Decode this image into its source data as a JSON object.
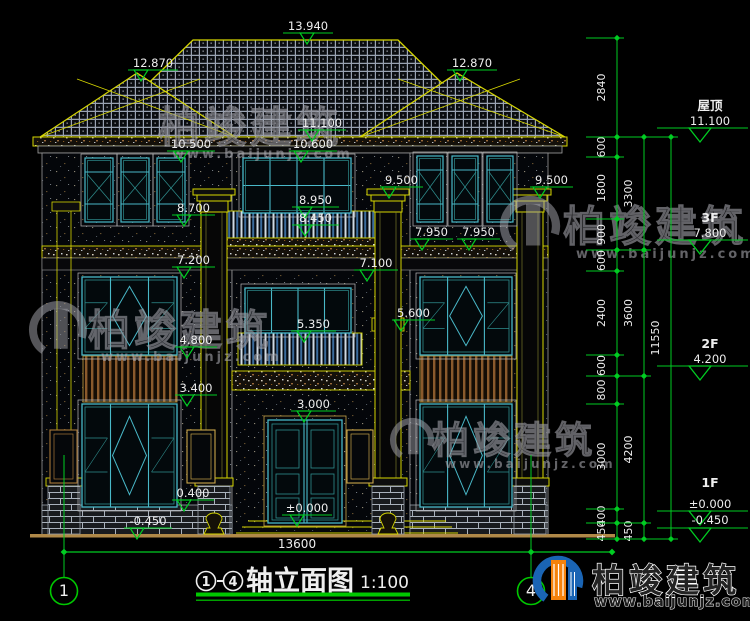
{
  "drawing_title": {
    "axis_from": "1",
    "axis_to": "4",
    "separator": "-",
    "text": "轴立面图",
    "scale": "1:100"
  },
  "axis_bubbles": [
    {
      "n": "1",
      "cx": 64
    },
    {
      "n": "4",
      "cx": 531
    }
  ],
  "bottom_dimension": {
    "value": "13600",
    "x1": 64,
    "x2": 531,
    "ext_x": 612,
    "y": 552,
    "text_x": 297,
    "text_y": 548
  },
  "elevation_markers": [
    {
      "v": "13.940",
      "x": 283,
      "w": 50,
      "y": 33,
      "tx": 307
    },
    {
      "v": "12.870",
      "x": 128,
      "w": 50,
      "y": 70,
      "tx": 141
    },
    {
      "v": "12.870",
      "x": 447,
      "w": 50,
      "y": 70,
      "tx": 460
    },
    {
      "v": "11.100",
      "x": 298,
      "w": 48,
      "y": 130,
      "tx": 312
    },
    {
      "v": "10.500",
      "x": 167,
      "w": 48,
      "y": 151,
      "tx": 181
    },
    {
      "v": "10.600",
      "x": 289,
      "w": 48,
      "y": 151,
      "tx": 301
    },
    {
      "v": "9.500",
      "x": 380,
      "w": 43,
      "y": 187,
      "tx": 389
    },
    {
      "v": "9.500",
      "x": 530,
      "w": 43,
      "y": 187,
      "tx": 540
    },
    {
      "v": "8.950",
      "x": 292,
      "w": 47,
      "y": 207,
      "tx": 305
    },
    {
      "v": "8.700",
      "x": 172,
      "w": 43,
      "y": 215,
      "tx": 184
    },
    {
      "v": "8.450",
      "x": 292,
      "w": 47,
      "y": 225,
      "tx": 305
    },
    {
      "v": "7.950",
      "x": 410,
      "w": 43,
      "y": 239,
      "tx": 422
    },
    {
      "v": "7.950",
      "x": 457,
      "w": 43,
      "y": 239,
      "tx": 469
    },
    {
      "v": "7.200",
      "x": 172,
      "w": 43,
      "y": 267,
      "tx": 184
    },
    {
      "v": "7.100",
      "x": 354,
      "w": 44,
      "y": 270,
      "tx": 367
    },
    {
      "v": "5.600",
      "x": 392,
      "w": 43,
      "y": 320,
      "tx": 401
    },
    {
      "v": "5.350",
      "x": 291,
      "w": 45,
      "y": 331,
      "tx": 304
    },
    {
      "v": "4.800",
      "x": 175,
      "w": 42,
      "y": 347,
      "tx": 187
    },
    {
      "v": "3.400",
      "x": 175,
      "w": 42,
      "y": 395,
      "tx": 187
    },
    {
      "v": "3.000",
      "x": 291,
      "w": 45,
      "y": 411,
      "tx": 304
    },
    {
      "v": "0.400",
      "x": 172,
      "w": 42,
      "y": 500,
      "tx": 184
    },
    {
      "v": "±0.000",
      "x": 282,
      "w": 50,
      "y": 515,
      "tx": 297
    },
    {
      "v": "-0.450",
      "x": 124,
      "w": 48,
      "y": 528,
      "tx": 137
    }
  ],
  "level_labels": [
    {
      "label": "屋顶",
      "value": "11.100",
      "line_y": 128,
      "label_y": 110,
      "value_y": 125
    },
    {
      "label": "3F",
      "value": "7.800",
      "line_y": 240,
      "label_y": 222,
      "value_y": 237
    },
    {
      "label": "2F",
      "value": "4.200",
      "line_y": 366,
      "label_y": 348,
      "value_y": 363
    },
    {
      "label": "1F",
      "value": "±0.000",
      "line_y": 511,
      "label_y": 487,
      "value_y": 508
    },
    {
      "label": "",
      "value": "-0.450",
      "line_y": 528,
      "label_y": 0,
      "value_y": 524
    }
  ],
  "dimension_columns": [
    {
      "x": 617,
      "tx": 605,
      "segments": [
        {
          "t": "2840",
          "a": 38,
          "b": 137
        },
        {
          "t": "600",
          "a": 137,
          "b": 157
        },
        {
          "t": "1800",
          "a": 157,
          "b": 219
        },
        {
          "t": "900",
          "a": 219,
          "b": 250
        },
        {
          "t": "600",
          "a": 250,
          "b": 271
        },
        {
          "t": "2400",
          "a": 271,
          "b": 355
        },
        {
          "t": "600",
          "a": 355,
          "b": 376
        },
        {
          "t": "800",
          "a": 376,
          "b": 404
        },
        {
          "t": "3000",
          "a": 404,
          "b": 509
        },
        {
          "t": "400",
          "a": 509,
          "b": 523
        },
        {
          "t": "450",
          "a": 523,
          "b": 539
        }
      ]
    },
    {
      "x": 644,
      "tx": 632,
      "segments": [
        {
          "t": "3300",
          "a": 137,
          "b": 250
        },
        {
          "t": "3600",
          "a": 250,
          "b": 376
        },
        {
          "t": "4200",
          "a": 376,
          "b": 523
        },
        {
          "t": "450",
          "a": 523,
          "b": 539
        }
      ]
    },
    {
      "x": 671,
      "tx": 659,
      "segments": [
        {
          "t": "11550",
          "a": 137,
          "b": 539
        }
      ]
    }
  ],
  "watermarks": [
    {
      "cn": "柏竣建筑",
      "url": "www.baijunjz.com",
      "tx": 158,
      "ty": 142,
      "size": 42,
      "ux": 172,
      "uy": 158,
      "us": 13,
      "logo": null
    },
    {
      "cn": "柏竣建筑",
      "url": "www.baijunjz.com",
      "tx": 563,
      "ty": 241,
      "size": 42,
      "ux": 576,
      "uy": 258,
      "us": 13,
      "logo": {
        "x": 530,
        "y": 226,
        "r": 26
      }
    },
    {
      "cn": "柏竣建筑",
      "url": "www.baijunjz.com",
      "tx": 88,
      "ty": 345,
      "size": 42,
      "ux": 101,
      "uy": 361,
      "us": 13,
      "logo": {
        "x": 58,
        "y": 330,
        "r": 25
      }
    },
    {
      "cn": "柏竣建筑",
      "url": "www.baijunjz.com",
      "tx": 432,
      "ty": 453,
      "size": 37,
      "ux": 445,
      "uy": 468,
      "us": 12,
      "logo": {
        "x": 412,
        "y": 440,
        "r": 19
      }
    }
  ],
  "brand_logo": {
    "name": "柏竣建筑",
    "url": "www.baijunjz.com"
  },
  "colors": {
    "green": "#00cc22",
    "yellow": "#d6d600",
    "teal": "#49b8c8",
    "teal_dark": "#2f8f8f",
    "white": "#eeeeee",
    "underline": "#00c800",
    "brand_blue": "#1a64b4",
    "brand_orange": "#f5820a"
  }
}
